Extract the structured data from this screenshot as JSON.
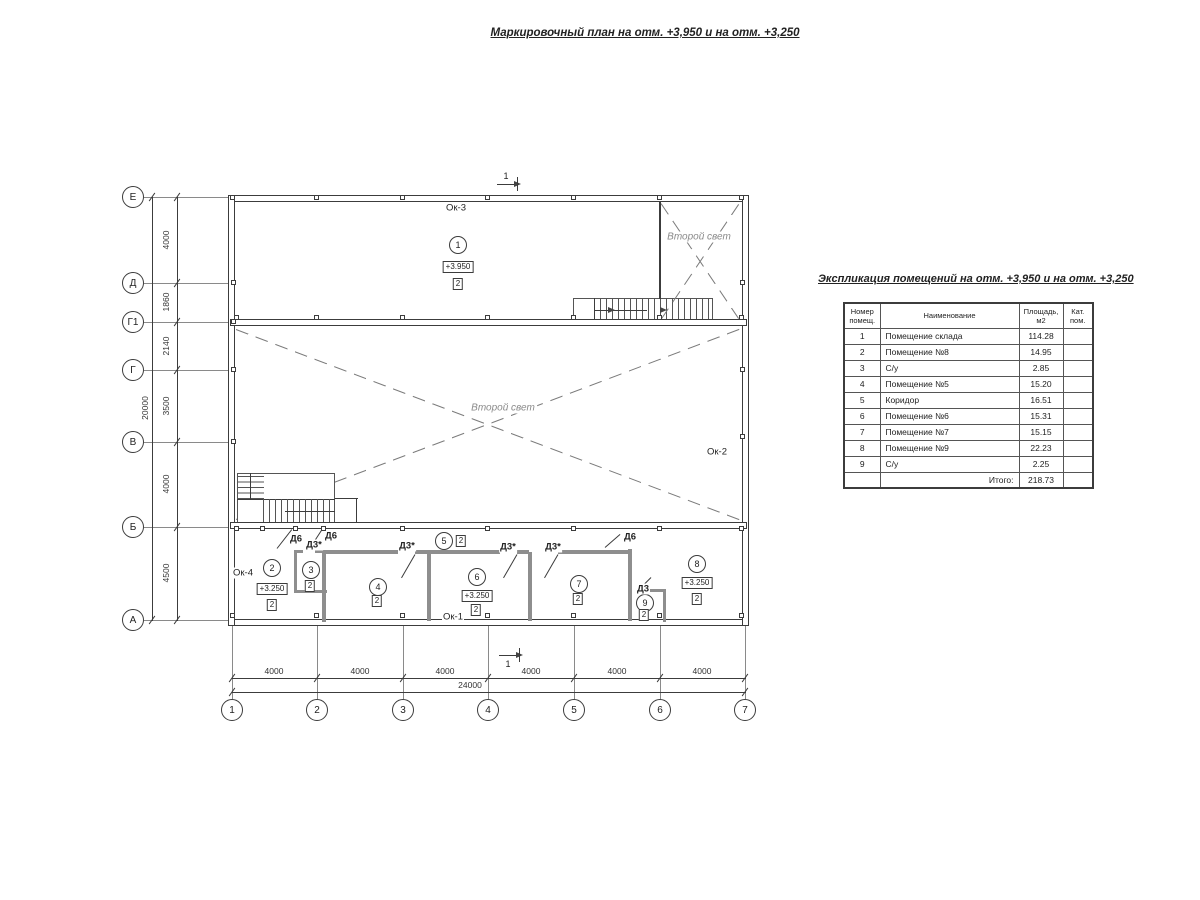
{
  "titles": {
    "main": "Маркировочный план на отм. +3,950 и на отм. +3,250"
  },
  "plan": {
    "labels": [
      {
        "k": "c",
        "t": "1",
        "x": 458,
        "y": 245
      },
      {
        "k": "c",
        "t": "2",
        "x": 272,
        "y": 568
      },
      {
        "k": "c",
        "t": "3",
        "x": 311,
        "y": 570
      },
      {
        "k": "c",
        "t": "4",
        "x": 378,
        "y": 587
      },
      {
        "k": "c",
        "t": "5",
        "x": 444,
        "y": 541
      },
      {
        "k": "c",
        "t": "6",
        "x": 477,
        "y": 577
      },
      {
        "k": "c",
        "t": "7",
        "x": 579,
        "y": 584
      },
      {
        "k": "c",
        "t": "8",
        "x": 697,
        "y": 564
      },
      {
        "k": "c",
        "t": "9",
        "x": 645,
        "y": 603
      },
      {
        "k": "e",
        "t": "+3.950",
        "x": 458,
        "y": 267
      },
      {
        "k": "e",
        "t": "+3.250",
        "x": 272,
        "y": 589
      },
      {
        "k": "e",
        "t": "+3.250",
        "x": 477,
        "y": 596
      },
      {
        "k": "e",
        "t": "+3.250",
        "x": 697,
        "y": 583
      },
      {
        "k": "b",
        "t": "2",
        "x": 458,
        "y": 284
      },
      {
        "k": "b",
        "t": "2",
        "x": 272,
        "y": 605
      },
      {
        "k": "b",
        "t": "2",
        "x": 310,
        "y": 586
      },
      {
        "k": "b",
        "t": "2",
        "x": 377,
        "y": 601
      },
      {
        "k": "b",
        "t": "2",
        "x": 461,
        "y": 541
      },
      {
        "k": "b",
        "t": "2",
        "x": 476,
        "y": 610
      },
      {
        "k": "b",
        "t": "2",
        "x": 578,
        "y": 599
      },
      {
        "k": "b",
        "t": "2",
        "x": 697,
        "y": 599
      },
      {
        "k": "b",
        "t": "2",
        "x": 644,
        "y": 615
      },
      {
        "k": "t",
        "t": "Ок-3",
        "x": 456,
        "y": 208
      },
      {
        "k": "t",
        "t": "Ок-2",
        "x": 717,
        "y": 452
      },
      {
        "k": "t",
        "t": "Ок-4",
        "x": 243,
        "y": 573
      },
      {
        "k": "t",
        "t": "Ок-1",
        "x": 453,
        "y": 617
      },
      {
        "k": "s",
        "t": "Второй свет",
        "x": 503,
        "y": 408
      },
      {
        "k": "s",
        "t": "Второй свет",
        "x": 699,
        "y": 237
      },
      {
        "k": "d",
        "t": "Д6",
        "x": 296,
        "y": 539
      },
      {
        "k": "d",
        "t": "Д6",
        "x": 331,
        "y": 536
      },
      {
        "k": "d",
        "t": "Д6",
        "x": 630,
        "y": 537
      },
      {
        "k": "d",
        "t": "Д3*",
        "x": 314,
        "y": 545
      },
      {
        "k": "d",
        "t": "Д3*",
        "x": 407,
        "y": 546
      },
      {
        "k": "d",
        "t": "Д3*",
        "x": 508,
        "y": 547
      },
      {
        "k": "d",
        "t": "Д3*",
        "x": 553,
        "y": 547
      },
      {
        "k": "d",
        "t": "Д3",
        "x": 643,
        "y": 589
      },
      {
        "k": "m",
        "t": "1",
        "x": 506,
        "y": 176
      },
      {
        "k": "m",
        "t": "1",
        "x": 508,
        "y": 664
      }
    ]
  },
  "axes": {
    "left": [
      {
        "t": "Е",
        "y": 197
      },
      {
        "t": "Д",
        "y": 283
      },
      {
        "t": "Г1",
        "y": 322
      },
      {
        "t": "Г",
        "y": 370
      },
      {
        "t": "В",
        "y": 442
      },
      {
        "t": "Б",
        "y": 527
      },
      {
        "t": "А",
        "y": 620
      }
    ],
    "bottom": [
      {
        "t": "1",
        "x": 232
      },
      {
        "t": "2",
        "x": 317
      },
      {
        "t": "3",
        "x": 403
      },
      {
        "t": "4",
        "x": 488
      },
      {
        "t": "5",
        "x": 574
      },
      {
        "t": "6",
        "x": 660
      },
      {
        "t": "7",
        "x": 745
      }
    ]
  },
  "dims": {
    "left": [
      {
        "t": "4000",
        "y": 240
      },
      {
        "t": "1860",
        "y": 302
      },
      {
        "t": "2140",
        "y": 346
      },
      {
        "t": "3500",
        "y": 406
      },
      {
        "t": "4000",
        "y": 484
      },
      {
        "t": "4500",
        "y": 573
      }
    ],
    "left_total": {
      "t": "20000",
      "y": 408
    },
    "bottom": [
      {
        "t": "4000",
        "x": 274
      },
      {
        "t": "4000",
        "x": 360
      },
      {
        "t": "4000",
        "x": 445
      },
      {
        "t": "4000",
        "x": 531
      },
      {
        "t": "4000",
        "x": 617
      },
      {
        "t": "4000",
        "x": 702
      }
    ],
    "bottom_total": {
      "t": "24000",
      "x": 470
    }
  },
  "table": {
    "title": "Экспликация помещений на отм. +3,950 и на отм. +3,250",
    "headers": [
      "Номер помещ.",
      "Наименование",
      "Площадь, м2",
      "Кат. пом."
    ],
    "rows": [
      {
        "n": "1",
        "name": "Помещение склада",
        "area": "114.28",
        "cat": ""
      },
      {
        "n": "2",
        "name": "Помещение №8",
        "area": "14.95",
        "cat": ""
      },
      {
        "n": "3",
        "name": "С/у",
        "area": "2.85",
        "cat": ""
      },
      {
        "n": "4",
        "name": "Помещение №5",
        "area": "15.20",
        "cat": ""
      },
      {
        "n": "5",
        "name": "Коридор",
        "area": "16.51",
        "cat": ""
      },
      {
        "n": "6",
        "name": "Помещение №6",
        "area": "15.31",
        "cat": ""
      },
      {
        "n": "7",
        "name": "Помещение №7",
        "area": "15.15",
        "cat": ""
      },
      {
        "n": "8",
        "name": "Помещение №9",
        "area": "22.23",
        "cat": ""
      },
      {
        "n": "9",
        "name": "С/у",
        "area": "2.25",
        "cat": ""
      }
    ],
    "total_label": "Итого:",
    "total_value": "218.73"
  }
}
